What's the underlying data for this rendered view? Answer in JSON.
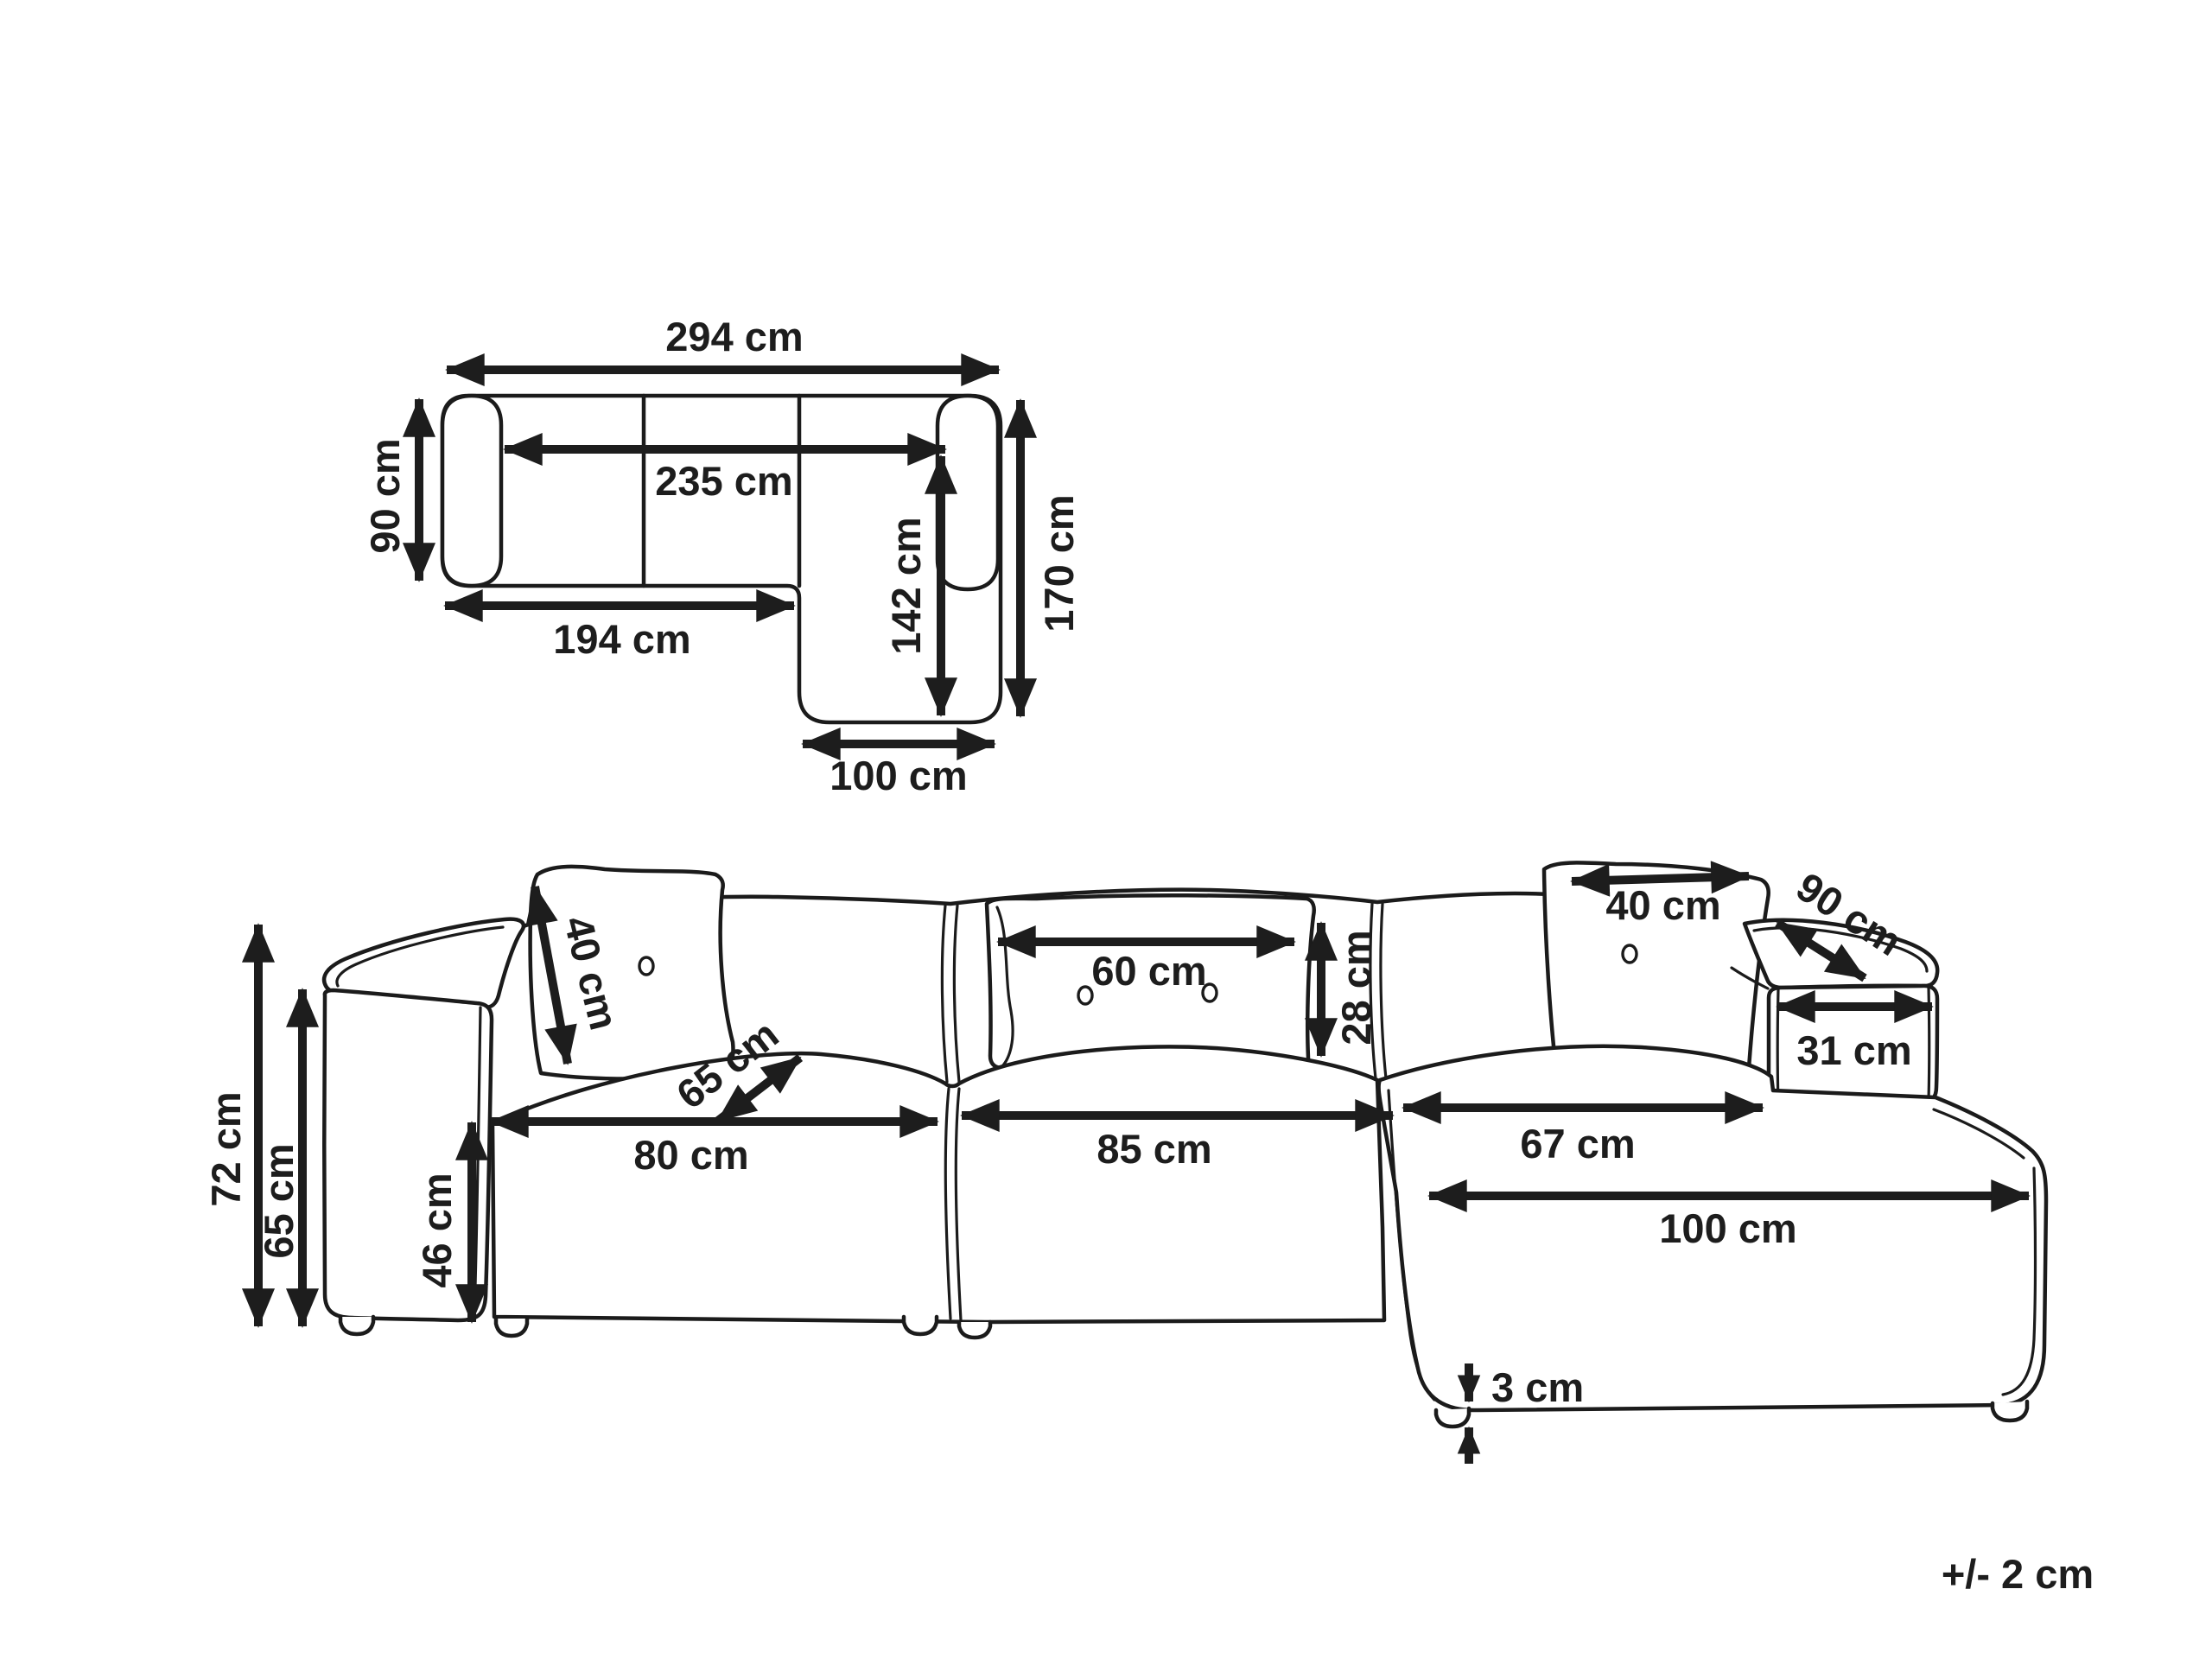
{
  "tolerance_note": "+/- 2 cm",
  "plan_view": {
    "total_width": "294 cm",
    "side_depth": "90 cm",
    "inner_width": "235 cm",
    "left_section_length": "194 cm",
    "chaise_length_inner": "142 cm",
    "total_depth_right": "170 cm",
    "chaise_width": "100 cm"
  },
  "front_view": {
    "total_height": "72 cm",
    "back_height": "65 cm",
    "seat_height": "46 cm",
    "left_pillow_size": "40 cm",
    "seat_depth": "65 cm",
    "left_seat_width": "80 cm",
    "middle_pillow_width": "60 cm",
    "middle_pillow_height": "28 cm",
    "middle_seat_width": "85 cm",
    "right_pillow_size": "40 cm",
    "right_armrest_depth": "90 cm",
    "right_armrest_width": "31 cm",
    "corner_seat_width": "67 cm",
    "chaise_front_length": "100 cm",
    "leg_height": "3 cm"
  }
}
